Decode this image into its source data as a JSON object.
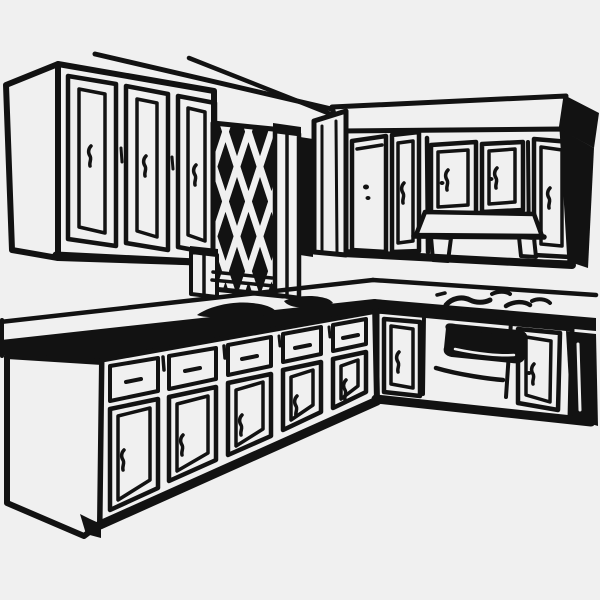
{
  "meta": {
    "kind": "clip-art-illustration",
    "style": "black ink line drawing on light gray background"
  },
  "palette": {
    "background": "#f0f0f0",
    "ink": "#121212",
    "paper": "#f0f0f0"
  },
  "scene": {
    "alt": "Black-and-white line drawing of an L-shaped kitchen: upper wall cabinets on two walls, a diamond-lattice window panel between them, base cabinets with drawers and doors, a countertop with sink, stovetop burner marks and a built-in oven with a range hood above.",
    "objects": [
      {
        "name": "ceiling-lines",
        "depicts": "soffit and ceiling edge lines"
      },
      {
        "name": "upper-cabinets-left",
        "depicts": "three upper cabinet doors with squiggle handles"
      },
      {
        "name": "lattice-window",
        "depicts": "diamond lattice decorative panel with side pilasters"
      },
      {
        "name": "upper-cabinets-right",
        "depicts": "upper cabinet run with crown band and five doors"
      },
      {
        "name": "range-hood",
        "depicts": "vent hood under center upper doors"
      },
      {
        "name": "countertop",
        "depicts": "L-shaped counter with backsplash"
      },
      {
        "name": "sink-marks",
        "depicts": "dark sink shading on counter"
      },
      {
        "name": "burner-marks",
        "depicts": "stovetop burner squiggles on counter"
      },
      {
        "name": "base-cabinets-left",
        "depicts": "five bays of drawers over doors"
      },
      {
        "name": "oven",
        "depicts": "built-in oven with dark window and handle bar"
      },
      {
        "name": "toe-kick",
        "depicts": "toe kick notch at cabinet base"
      }
    ]
  }
}
